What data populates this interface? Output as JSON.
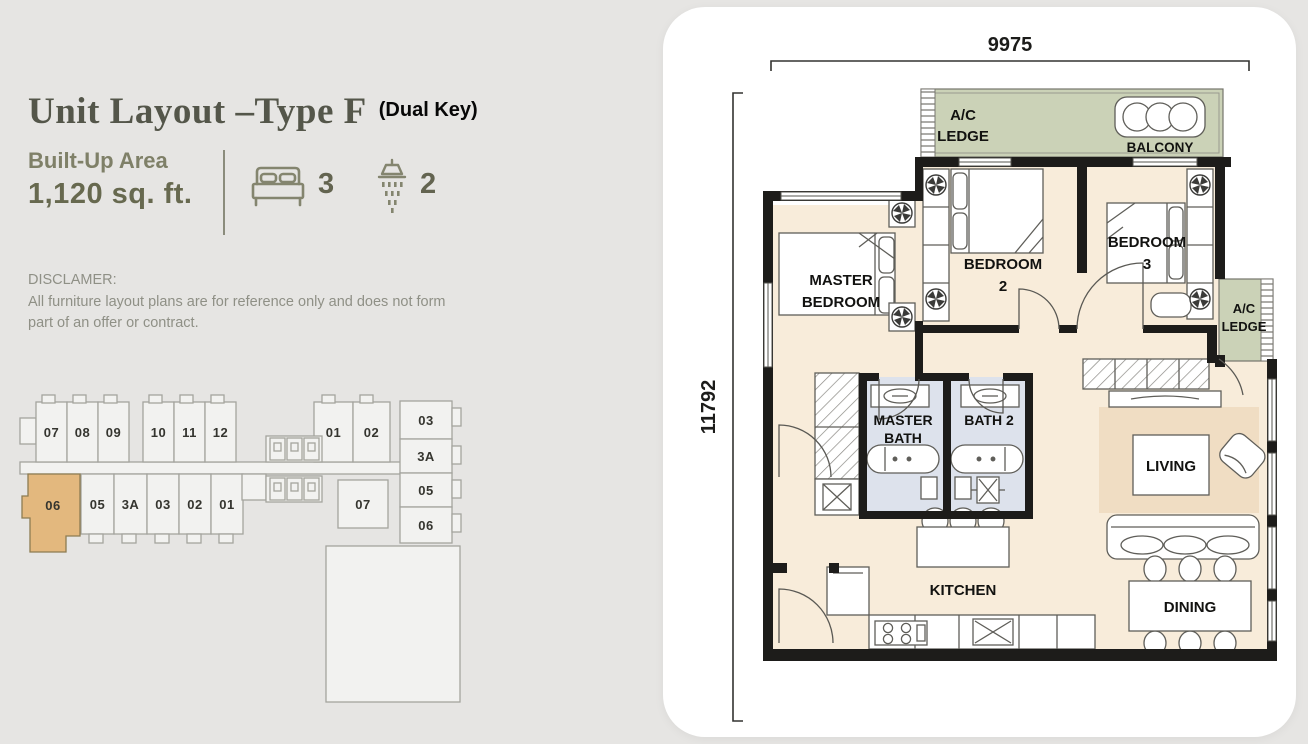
{
  "page": {
    "background": "#e6e5e3",
    "card_background": "#ffffff"
  },
  "header": {
    "title": "Unit Layout –Type F",
    "dual_key": "(Dual Key)",
    "built_up_label": "Built-Up Area",
    "built_up_value": "1,120 sq. ft.",
    "bedroom_count": "3",
    "bathroom_count": "2"
  },
  "disclaimer": {
    "heading": "DISCLAMER:",
    "line1": "All furniture layout plans are for reference only and does not form",
    "line2": "part of an offer or contract."
  },
  "key_plan": {
    "highlighted_unit": "06",
    "highlight_color": "#e3b87e",
    "units": [
      "07",
      "08",
      "09",
      "10",
      "11",
      "12",
      "01",
      "02",
      "06",
      "05",
      "3A",
      "03",
      "02",
      "01",
      "07",
      "03",
      "3A",
      "05",
      "06"
    ]
  },
  "floor_plan": {
    "dim_top": "9975",
    "dim_left": "11792",
    "labels": {
      "ac_ledge_line1": "A/C",
      "ac_ledge_line2": "LEDGE",
      "balcony": "BALCONY",
      "master_line1": "MASTER",
      "master_line2": "BEDROOM",
      "bedroom2_line1": "BEDROOM",
      "bedroom2_line2": "2",
      "bedroom3_line1": "BEDROOM",
      "bedroom3_line2": "3",
      "master_bath_line1": "MASTER",
      "master_bath_line2": "BATH",
      "bath2": "BATH 2",
      "living": "LIVING",
      "dining": "DINING",
      "kitchen": "KITCHEN",
      "ac_ledge2_line1": "A/C",
      "ac_ledge2_line2": "LEDGE"
    },
    "colors": {
      "wall": "#1d1c1a",
      "floor": "#f8ecda",
      "bath": "#dde2ec",
      "ledge": "#cbd2b7",
      "rug": "#f0ddc3"
    }
  }
}
